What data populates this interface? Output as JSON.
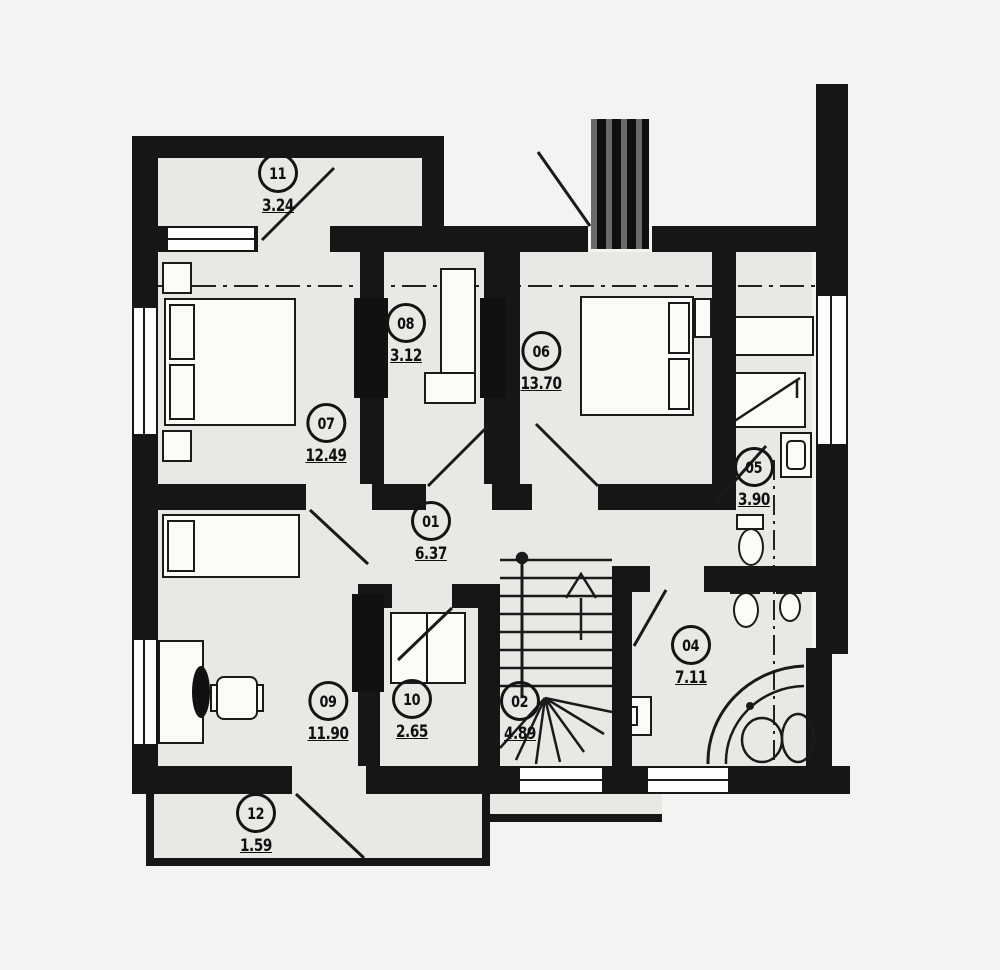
{
  "title": "Upper floor plan",
  "colors": {
    "wall": "#161616",
    "floor": "#e8e8e5",
    "page": "#f3f3f1",
    "furniture": "#fbfbf8",
    "line": "#1a1a1a"
  },
  "rooms": [
    {
      "number": "11",
      "area": "3.24"
    },
    {
      "number": "07",
      "area": "12.49"
    },
    {
      "number": "08",
      "area": "3.12"
    },
    {
      "number": "06",
      "area": "13.70"
    },
    {
      "number": "05",
      "area": "3.90"
    },
    {
      "number": "01",
      "area": "6.37"
    },
    {
      "number": "09",
      "area": "11.90"
    },
    {
      "number": "10",
      "area": "2.65"
    },
    {
      "number": "02",
      "area": "4.89"
    },
    {
      "number": "04",
      "area": "7.11"
    },
    {
      "number": "12",
      "area": "1.59"
    }
  ]
}
